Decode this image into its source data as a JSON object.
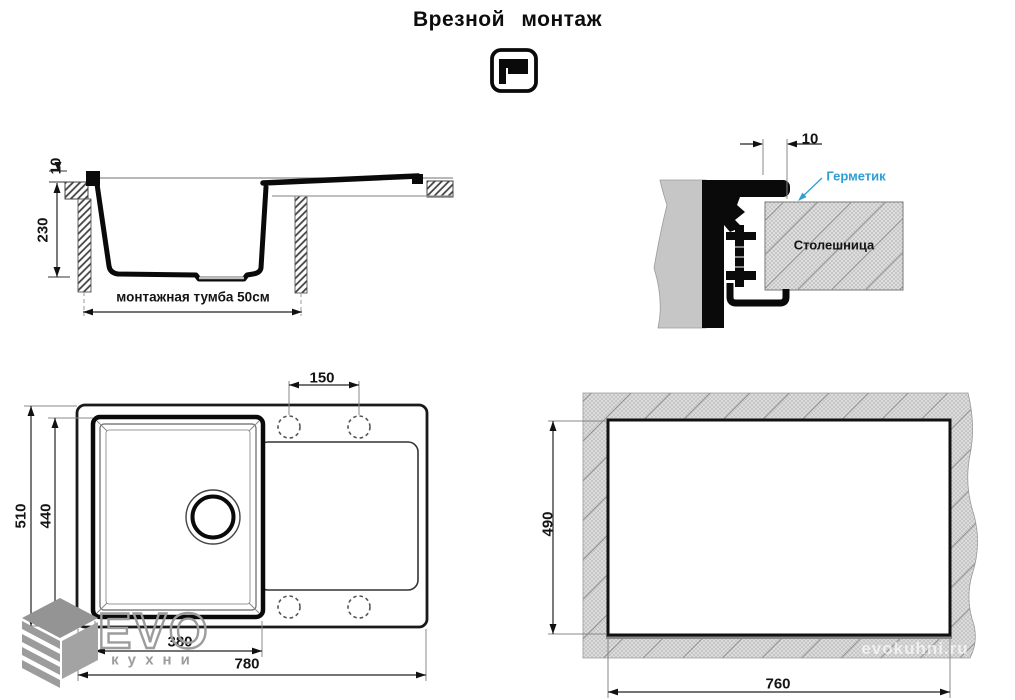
{
  "header": {
    "title": "Врезной монтаж"
  },
  "icons": {
    "mount_icon": "inset-mount-pictogram",
    "logo_icon": "evo-layered-cube"
  },
  "section_view": {
    "rim_height": "10",
    "bowl_depth": "230",
    "cabinet_label": "монтажная тумба 50см"
  },
  "detail_view": {
    "overhang": "10",
    "sealant_label": "Герметик",
    "sealant_color": "#2f9fd3",
    "countertop_label": "Столешница"
  },
  "top_view": {
    "tap_hole_spacing": "150",
    "overall_depth": "510",
    "bowl_length": "440",
    "bowl_width": "380",
    "overall_width": "780"
  },
  "cutout_view": {
    "cutout_depth": "490",
    "cutout_width": "760"
  },
  "branding": {
    "logo_main": "EVO",
    "logo_sub": "кухни",
    "watermark": "evokuhni.ru"
  }
}
